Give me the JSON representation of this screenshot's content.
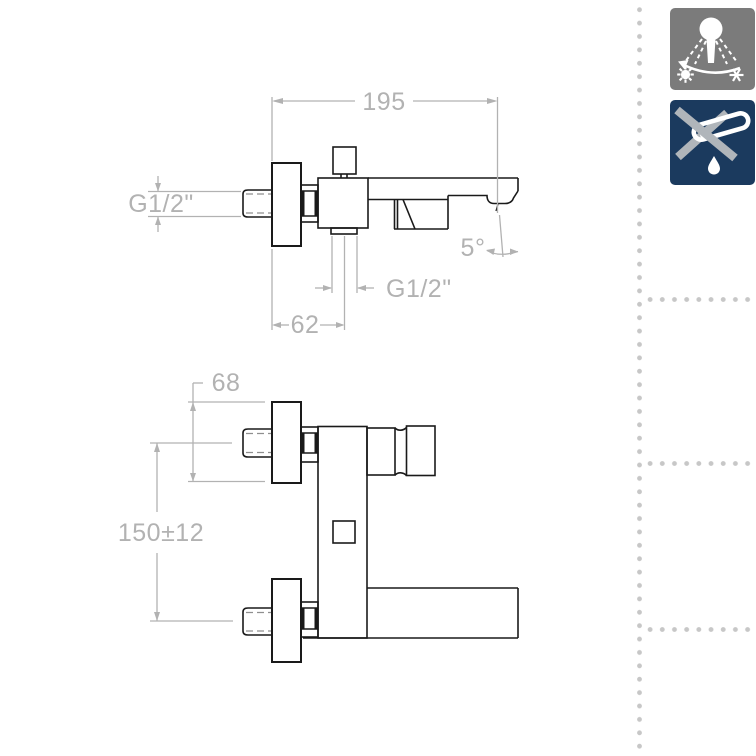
{
  "page": {
    "background": "#ffffff"
  },
  "drawing": {
    "stroke_color": "#1a1a1a",
    "dimension_color": "#b2b2b2",
    "top_view": {
      "overall_depth": "195",
      "inlet_thread_label": "G1/2\"",
      "shower_outlet_thread_label": "G1/2\"",
      "spout_angle": "5°",
      "outlet_offset": "62"
    },
    "front_view": {
      "escutcheon_size": "68",
      "inlet_centers_distance": "150±12"
    }
  },
  "sidebar_icons": [
    {
      "name": "shower-temperature-range-icon",
      "background": "#7b7b7b",
      "glyph_color": "#ffffff"
    },
    {
      "name": "no-drip-spout-icon",
      "background": "#1b3a5e",
      "glyph_color": "#ffffff",
      "cross_color": "#b0b5ba"
    }
  ],
  "separators": {
    "dot_color": "#c7c7c7"
  }
}
